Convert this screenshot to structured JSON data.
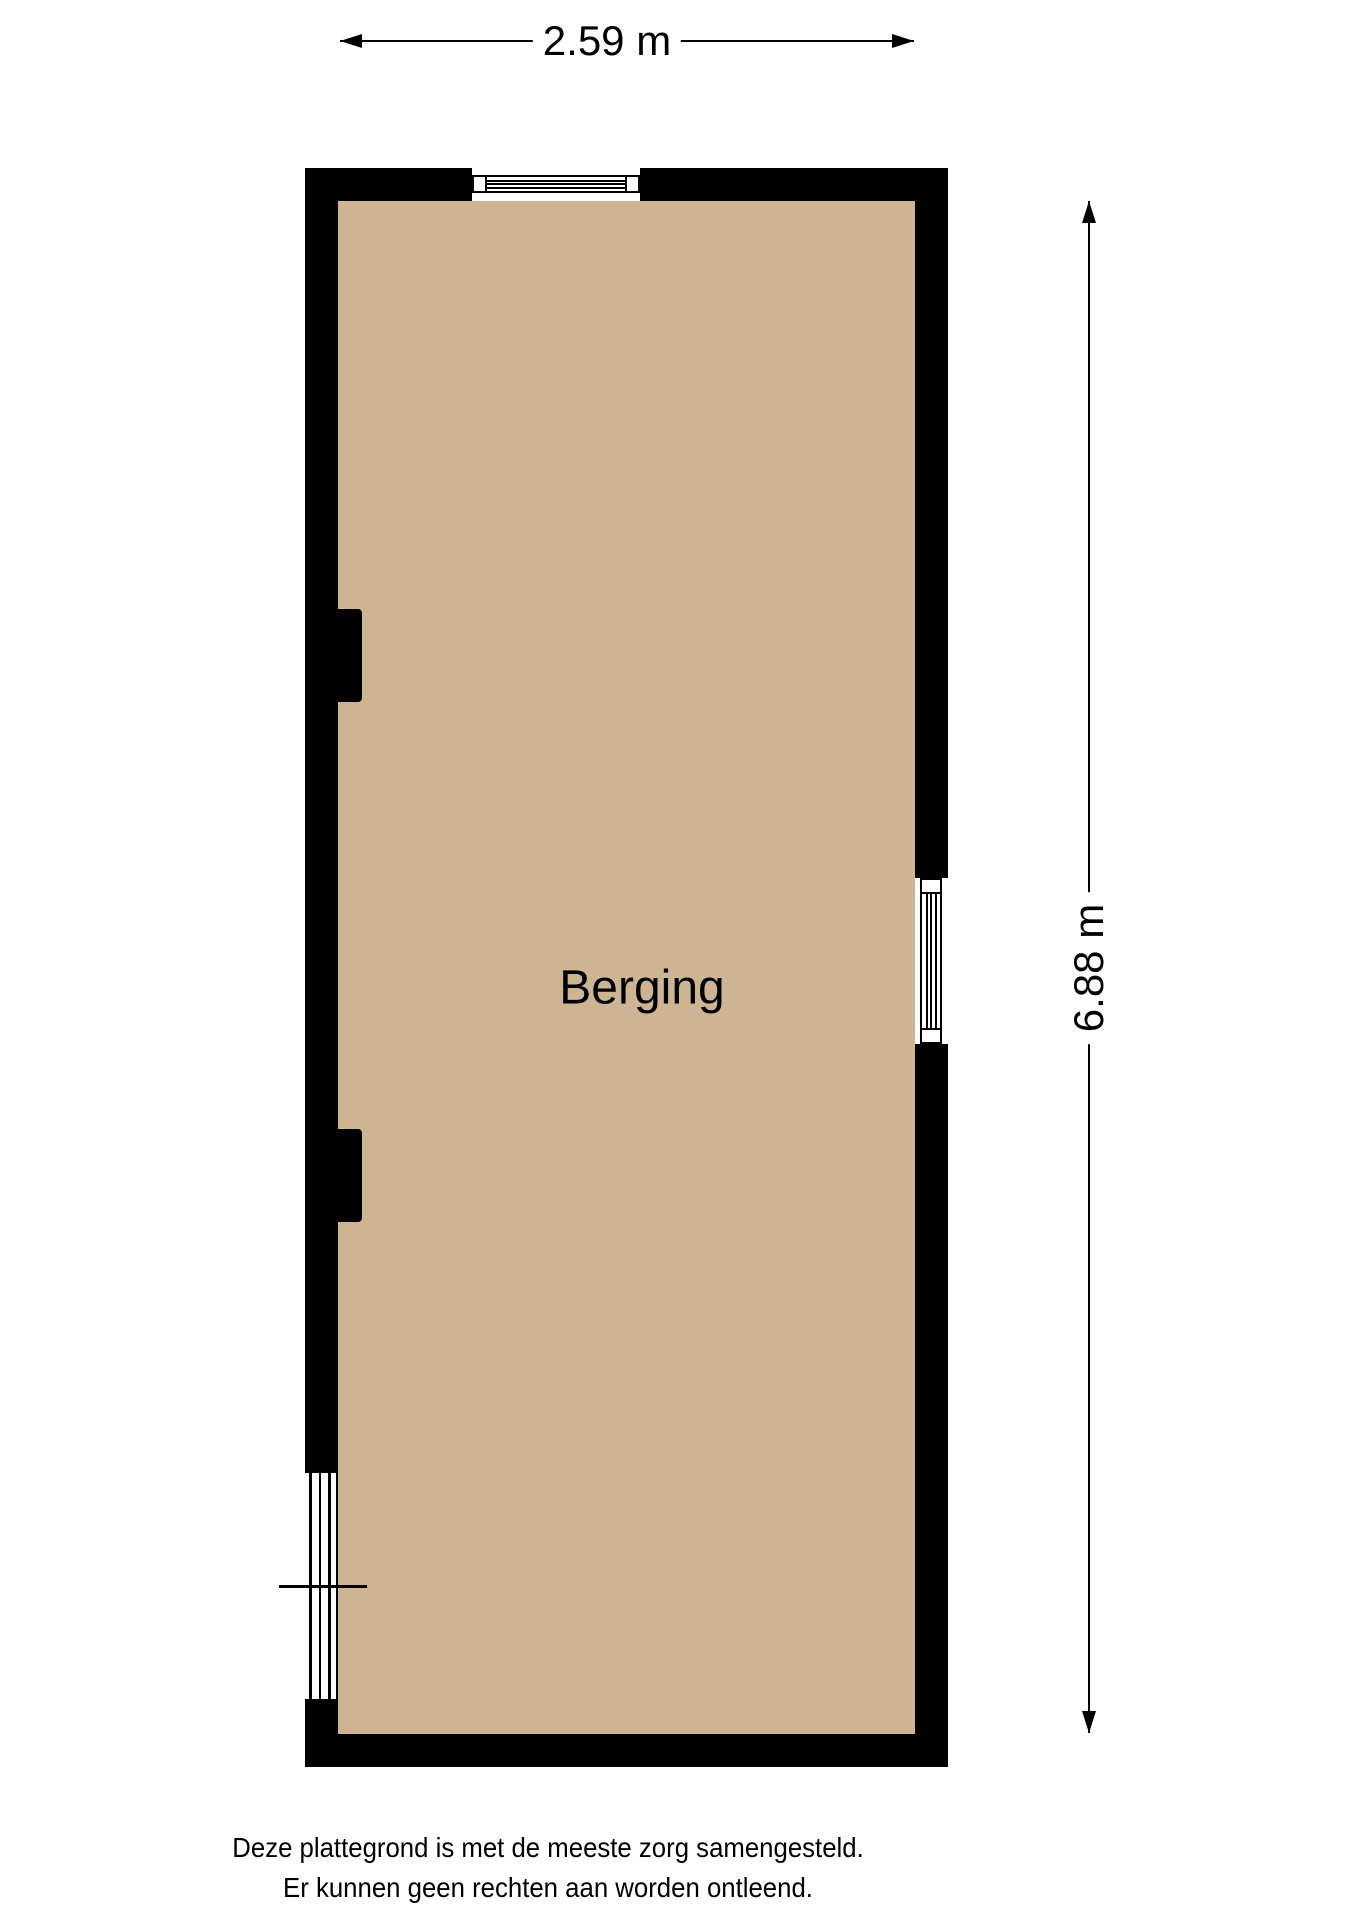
{
  "dimensions": {
    "width_label": "2.59 m",
    "height_label": "6.88 m"
  },
  "room": {
    "label": "Berging"
  },
  "footer": {
    "line1": "Deze plattegrond is met de meeste zorg samengesteld.",
    "line2": "Er kunnen geen rechten aan worden ontleend."
  },
  "colors": {
    "floor": "#cdb593",
    "wall": "#000000",
    "line": "#000000"
  }
}
